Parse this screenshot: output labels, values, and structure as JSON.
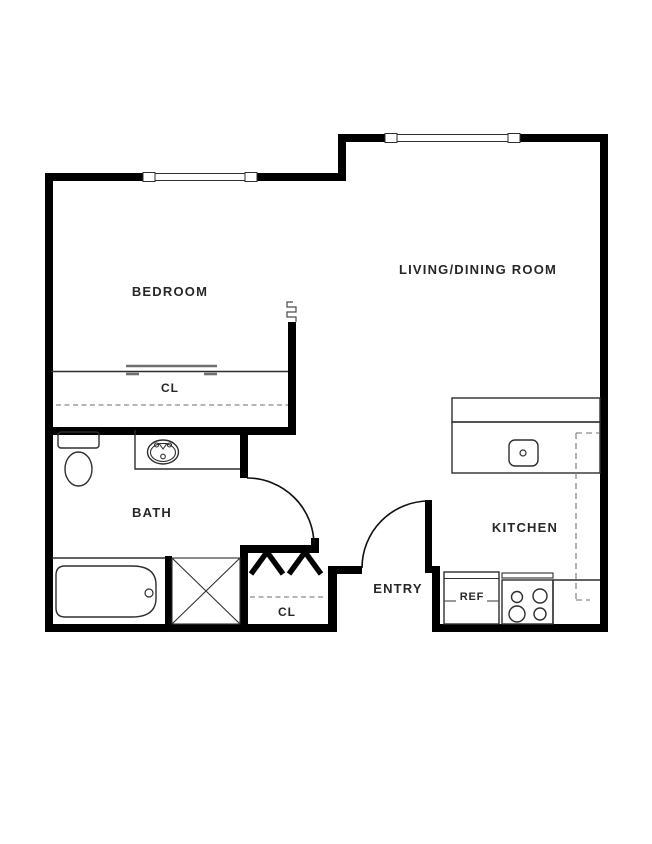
{
  "title": "Studio Apartment Floor Plan",
  "colors": {
    "wall": "#000000",
    "thin_line": "#2e2e2e",
    "dashed_line": "#8a8a8a",
    "closet_door_line": "#6f6f6f",
    "label_text": "#2a2627",
    "background": "#ffffff"
  },
  "rooms": {
    "bedroom": {
      "label": "BEDROOM"
    },
    "living_dining": {
      "label": "LIVING/DINING ROOM"
    },
    "bath": {
      "label": "BATH"
    },
    "kitchen": {
      "label": "KITCHEN"
    },
    "entry": {
      "label": "ENTRY"
    },
    "bedroom_closet": {
      "label": "CL"
    },
    "entry_closet": {
      "label": "CL"
    }
  },
  "appliances": {
    "refrigerator": {
      "label": "REF"
    }
  },
  "fixture_icons": [
    "toilet-icon",
    "bathroom-sink-icon",
    "bathtub-icon",
    "shower-icon",
    "kitchen-sink-icon",
    "range-burners-icon",
    "refrigerator-icon",
    "door-swing-arc-icon",
    "window-icon",
    "closet-rod-bracket-icon",
    "sliding-closet-door-icon",
    "wall-break-icon",
    "upper-cabinet-dashed-icon"
  ]
}
